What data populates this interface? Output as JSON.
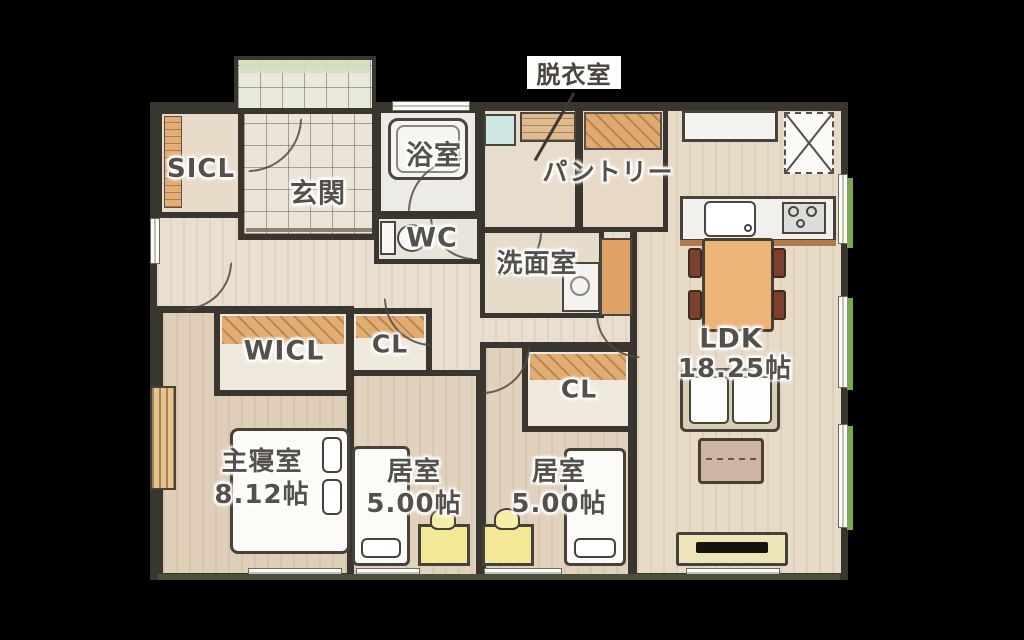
{
  "title": "floor-plan",
  "rooms": {
    "datsui": {
      "label": "脱衣室"
    },
    "sicl": {
      "label": "SICL"
    },
    "genkan": {
      "label": "玄関"
    },
    "bath": {
      "label": "浴室"
    },
    "pantry": {
      "label": "パントリー"
    },
    "wc": {
      "label": "WC"
    },
    "senmen": {
      "label": "洗面室"
    },
    "wicl": {
      "label": "WICL"
    },
    "cl1": {
      "label": "CL"
    },
    "cl2": {
      "label": "CL"
    },
    "ldk": {
      "label": "LDK",
      "area": "18.25帖"
    },
    "master": {
      "label": "主寝室",
      "area": "8.12帖"
    },
    "room1": {
      "label": "居室",
      "area": "5.00帖"
    },
    "room2": {
      "label": "居室",
      "area": "5.00帖"
    }
  },
  "colors": {
    "background": "#000000",
    "wall": "#39352f",
    "hall_floor": "#eadfce",
    "wood_floor": "#e0cfba",
    "tile_floor": "#ece4d6",
    "closet_orange": "#e3ac70",
    "bath_white": "#f4f3ef",
    "desk_yellow": "#f2e895",
    "table_orange": "#edb477",
    "hedge_green": "#7fa653",
    "laundry_teal": "#cde8e2"
  }
}
